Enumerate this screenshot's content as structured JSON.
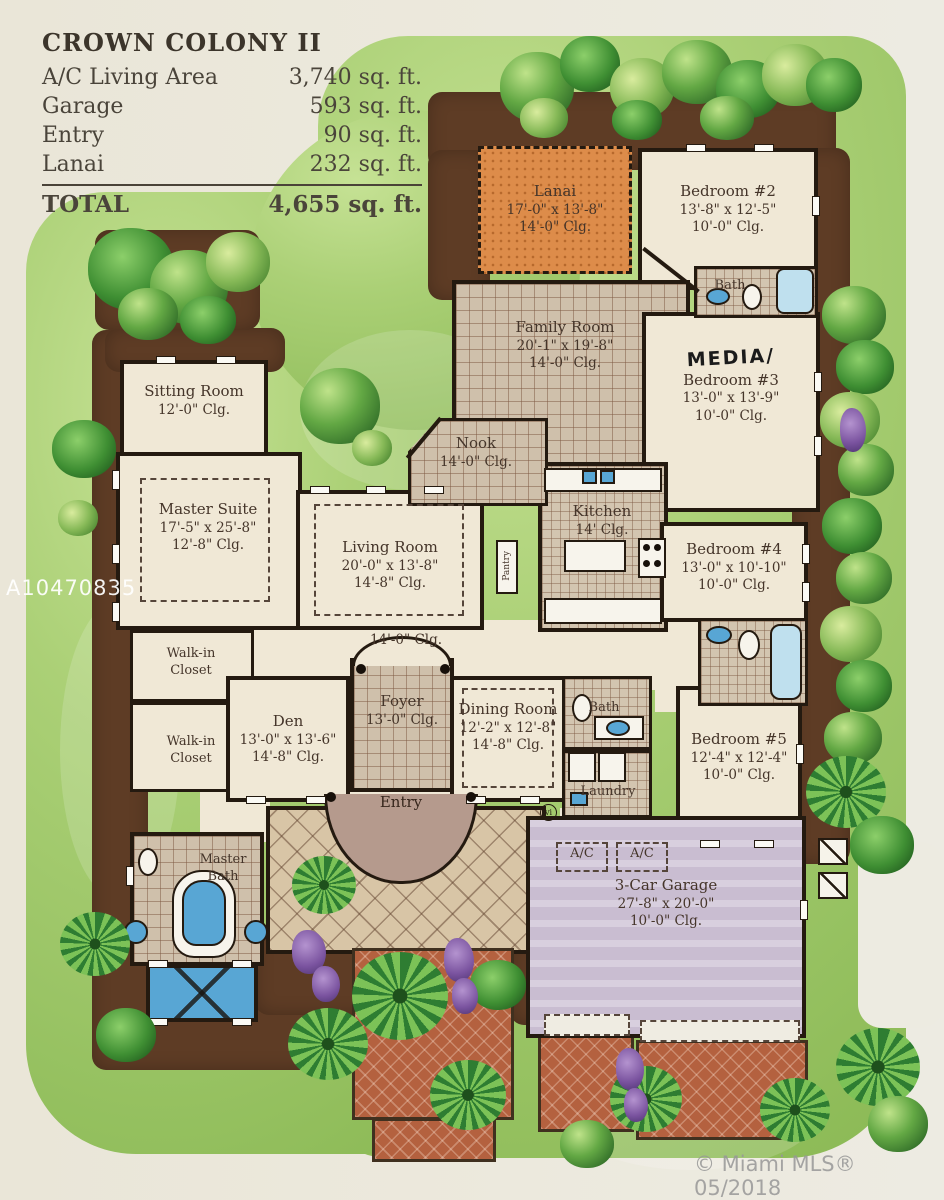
{
  "legend": {
    "title": "CROWN COLONY II",
    "rows": [
      {
        "label": "A/C Living Area",
        "value": "3,740 sq. ft."
      },
      {
        "label": "Garage",
        "value": "593 sq. ft."
      },
      {
        "label": "Entry",
        "value": "90 sq. ft."
      },
      {
        "label": "Lanai",
        "value": "232 sq. ft."
      }
    ],
    "total": {
      "label": "TOTAL",
      "value": "4,655 sq. ft."
    }
  },
  "rooms": {
    "lanai": {
      "name": "Lanai",
      "dims": "17'-0\" x 13'-8\"",
      "clg": "14'-0\" Clg."
    },
    "bedroom2": {
      "name": "Bedroom #2",
      "dims": "13'-8\" x 12'-5\"",
      "clg": "10'-0\" Clg."
    },
    "bath2": {
      "name": "Bath"
    },
    "family": {
      "name": "Family Room",
      "dims": "20'-1\" x 19'-8\"",
      "clg": "14'-0\" Clg."
    },
    "media": {
      "annotation": "MEDIA/",
      "name": "Bedroom #3",
      "dims": "13'-0\" x 13'-9\"",
      "clg": "10'-0\" Clg."
    },
    "nook": {
      "name": "Nook",
      "clg": "14'-0\" Clg."
    },
    "sitting": {
      "name": "Sitting Room",
      "clg": "12'-0\" Clg."
    },
    "master": {
      "name": "Master Suite",
      "dims": "17'-5\" x 25'-8\"",
      "clg": "12'-8\" Clg."
    },
    "living": {
      "name": "Living Room",
      "dims": "20'-0\" x 13'-8\"",
      "clg": "14'-8\" Clg."
    },
    "kitchen": {
      "name": "Kitchen",
      "clg": "14' Clg."
    },
    "pantry": {
      "name": "Pantry"
    },
    "bedroom4": {
      "name": "Bedroom #4",
      "dims": "13'-0\" x 10'-10\"",
      "clg": "10'-0\" Clg."
    },
    "hall": {
      "clg": "14'-0\" Clg."
    },
    "wic1": {
      "name": "Walk-in Closet"
    },
    "wic2": {
      "name": "Walk-in Closet"
    },
    "den": {
      "name": "Den",
      "dims": "13'-0\" x 13'-6\"",
      "clg": "14'-8\" Clg."
    },
    "foyer": {
      "name": "Foyer",
      "clg": "13'-0\" Clg."
    },
    "dining": {
      "name": "Dining Room",
      "dims": "12'-2\" x 12'-8\"",
      "clg": "14'-8\" Clg."
    },
    "bathpool": {
      "name": "Bath"
    },
    "laundry": {
      "name": "Laundry"
    },
    "bedroom5": {
      "name": "Bedroom #5",
      "dims": "12'-4\" x 12'-4\"",
      "clg": "10'-0\" Clg."
    },
    "masterbath": {
      "name": "Master Bath"
    },
    "entry": {
      "name": "Entry"
    },
    "ac1": {
      "name": "A/C"
    },
    "ac2": {
      "name": "A/C"
    },
    "garage": {
      "name": "3-Car Garage",
      "dims": "27'-8\" x 20'-0\"",
      "clg": "10'-0\" Clg."
    },
    "marker_vi": {
      "text": "vi"
    }
  },
  "watermarks": {
    "listing_id": "A10470835",
    "mls": "© Miami MLS® 05/2018"
  },
  "colors": {
    "paper": "#ece9dd",
    "lawn": "#a9cf73",
    "planting_bed": "#5e3c25",
    "tile": "#cfc0ab",
    "lanai_floor": "#dd8c4a",
    "garage_floor": "#c9bdd1",
    "driveway": "#b4613f",
    "wall": "#241a10",
    "pool": "#58a6d4",
    "text": "#45352a"
  }
}
